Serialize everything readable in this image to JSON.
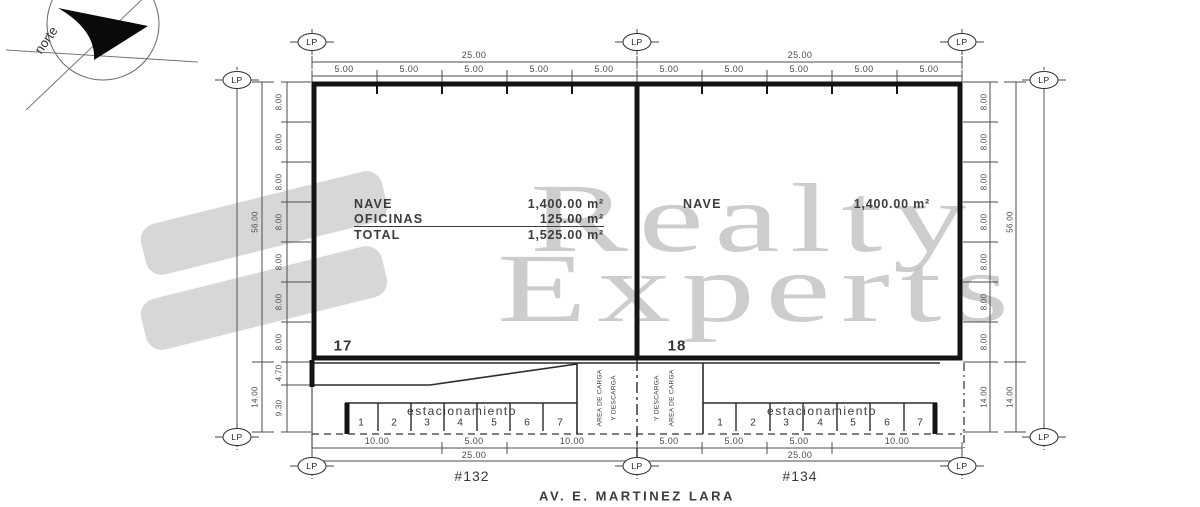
{
  "watermark": {
    "word1": "Realty",
    "word2": "Experts"
  },
  "north_arrow": {
    "label": "norte"
  },
  "markers": {
    "lp": "LP"
  },
  "colors": {
    "wall": "#141414",
    "line": "#2b2b2b",
    "dim_text": "#4c4c4c",
    "watermark_gray": "#bfbfbf",
    "logo_gray": "#d7d7d7"
  },
  "dims": {
    "top_left_overall": "25.00",
    "top_right_overall": "25.00",
    "top_left_segments": [
      "5.00",
      "5.00",
      "5.00",
      "5.00",
      "5.00"
    ],
    "top_right_segments": [
      "5.00",
      "5.00",
      "5.00",
      "5.00",
      "5.00"
    ],
    "left_outer": [
      "56.00",
      "14.00"
    ],
    "left_chain": [
      "8.00",
      "8.00",
      "8.00",
      "8.00",
      "8.00",
      "8.00",
      "8.00",
      "4.70",
      "9.30"
    ],
    "right_chain": [
      "8.00",
      "8.00",
      "8.00",
      "8.00",
      "8.00",
      "8.00",
      "8.00",
      "14.00"
    ],
    "right_outer": [
      "56.00",
      "14.00"
    ],
    "bottom_left_segments": [
      "10.00",
      "5.00",
      "10.00"
    ],
    "bottom_left_overall": "25.00",
    "bottom_right_segments": [
      "5.00",
      "5.00",
      "5.00",
      "10.00"
    ],
    "bottom_right_overall": "25.00"
  },
  "units": {
    "left": {
      "number": "17",
      "lot": "#132",
      "areas": {
        "rows": [
          {
            "label": "NAVE",
            "value": "1,400.00 m²"
          },
          {
            "label": "OFICINAS",
            "value": "125.00 m²"
          },
          {
            "label": "TOTAL",
            "value": "1,525.00 m²"
          }
        ]
      }
    },
    "right": {
      "number": "18",
      "lot": "#134",
      "areas": {
        "rows": [
          {
            "label": "NAVE",
            "value": "1,400.00 m²"
          }
        ]
      }
    }
  },
  "parking": {
    "label_left": "estacionamiento",
    "label_right": "estacionamiento",
    "stalls": [
      "1",
      "2",
      "3",
      "4",
      "5",
      "6",
      "7"
    ]
  },
  "loading_area": {
    "left_line1": "AREA DE CARGA",
    "left_line2": "Y DESCARGA",
    "right_line1": "Y DESCARGA",
    "right_line2": "AREA DE CARGA"
  },
  "street": {
    "name": "AV. E. MARTINEZ LARA"
  }
}
